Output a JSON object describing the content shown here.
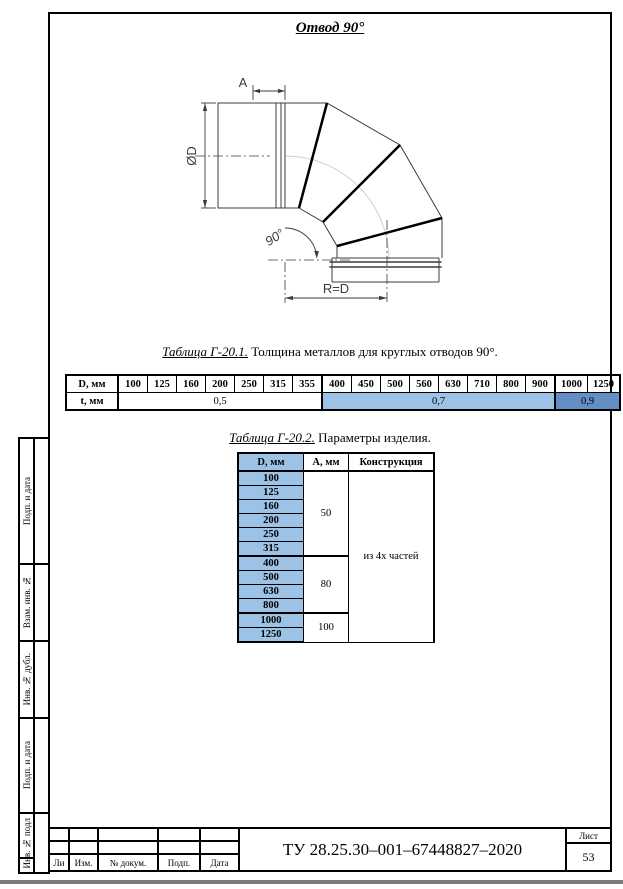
{
  "page": {
    "title": "Отвод 90°",
    "doc_number": "ТУ 28.25.30–001–67448827–2020",
    "sheet_label": "Лист",
    "sheet_number": "53"
  },
  "drawing": {
    "labels": {
      "a": "A",
      "d": "ØD",
      "angle": "90°",
      "radius": "R=D"
    }
  },
  "table1": {
    "caption_label": "Таблица Г-20.1.",
    "caption_text": " Толщина металлов для круглых отводов 90°.",
    "row_headers": [
      "D, мм",
      "t, мм"
    ],
    "diameters": [
      "100",
      "125",
      "160",
      "200",
      "250",
      "315",
      "355",
      "400",
      "450",
      "500",
      "560",
      "630",
      "710",
      "800",
      "900",
      "1000",
      "1250"
    ],
    "thickness_groups": [
      {
        "value": "0,5",
        "span": 7,
        "color": "#FFFFFF"
      },
      {
        "value": "0,7",
        "span": 8,
        "color": "#9CC2E5"
      },
      {
        "value": "0,9",
        "span": 2,
        "color": "#648FC4"
      }
    ]
  },
  "table2": {
    "caption_label": "Таблица Г-20.2.",
    "caption_text": " Параметры изделия.",
    "headers": [
      "D, мм",
      "A, мм",
      "Конструкция"
    ],
    "rows_d": [
      "100",
      "125",
      "160",
      "200",
      "250",
      "315",
      "400",
      "500",
      "630",
      "800",
      "1000",
      "1250"
    ],
    "a_groups": [
      {
        "value": "50",
        "span": 6
      },
      {
        "value": "80",
        "span": 4
      },
      {
        "value": "100",
        "span": 2
      }
    ],
    "construction": "из 4х частей",
    "d_col_color": "#9CC2E5"
  },
  "sidebar": {
    "items": [
      "Подп. и дата",
      "Взам. инв. №",
      "Инв. № дубл.",
      "Подп. и дата",
      "Инв. № подл"
    ]
  },
  "titleblock": {
    "labels": [
      "Ли",
      "Изм.",
      "№ докум.",
      "Подп.",
      "Дата"
    ]
  }
}
